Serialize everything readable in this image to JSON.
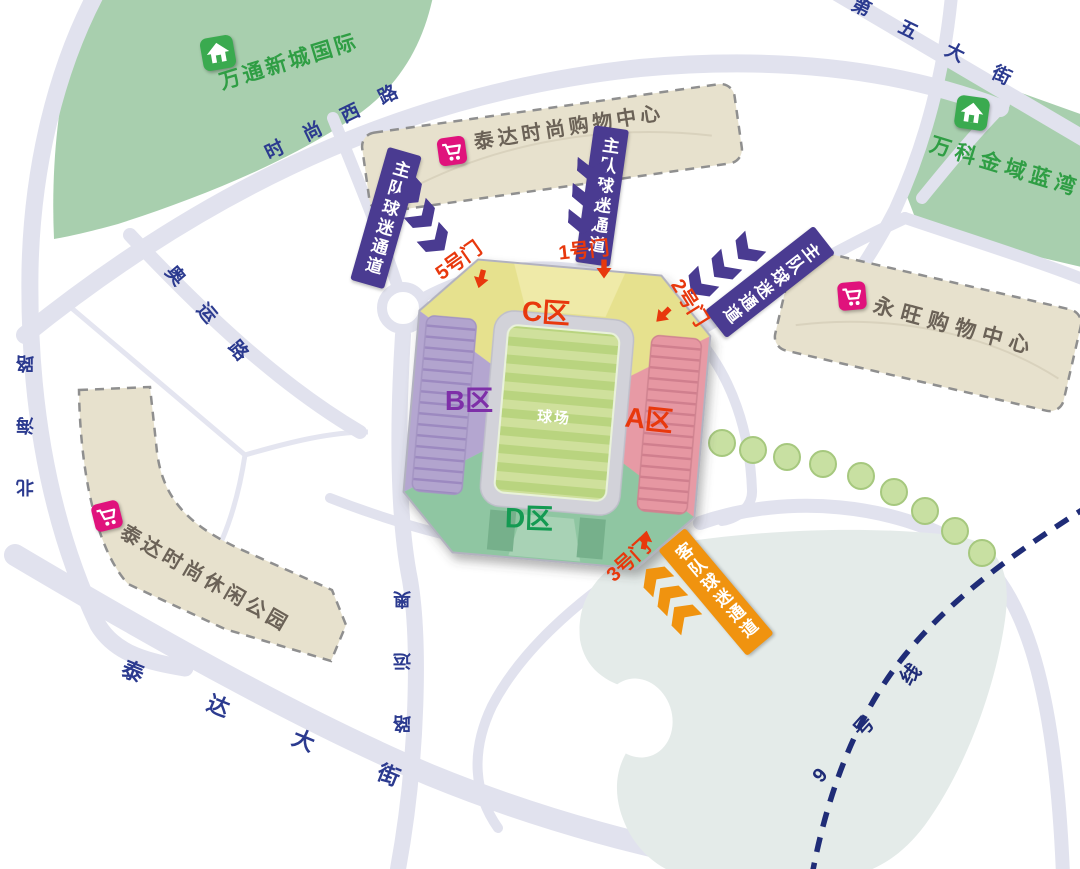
{
  "stadium": {
    "pitch_label": "球场",
    "zones": [
      {
        "id": "C",
        "label": "C区",
        "color": "#e6e18e",
        "label_color": "#e8380d"
      },
      {
        "id": "B",
        "label": "B区",
        "color": "#b4a6d0",
        "label_color": "#7e2fa8"
      },
      {
        "id": "A",
        "label": "A区",
        "color": "#e79aa5",
        "label_color": "#e8380d"
      },
      {
        "id": "D",
        "label": "D区",
        "color": "#8fc6a2",
        "label_color": "#149a52"
      }
    ],
    "gates": [
      {
        "id": "1",
        "label": "1号门"
      },
      {
        "id": "2",
        "label": "2号门"
      },
      {
        "id": "3",
        "label": "3号门"
      },
      {
        "id": "5",
        "label": "5号门"
      }
    ],
    "gate_color": "#e8380d"
  },
  "channels": {
    "home": {
      "label": "主队球迷通道",
      "color": "#4a3b91",
      "banner_count": 3
    },
    "away": {
      "label": "客队球迷通道",
      "color": "#f0930f",
      "banner_count": 1
    }
  },
  "landmarks": [
    {
      "name": "万通新城国际",
      "type": "residential",
      "icon": "home-icon",
      "text_color": "#2f9e44"
    },
    {
      "name": "泰达时尚购物中心",
      "type": "shopping",
      "icon": "cart-icon",
      "text_color": "#6b6257"
    },
    {
      "name": "万科金域蓝湾",
      "type": "residential",
      "icon": "home-icon",
      "text_color": "#2f9e44"
    },
    {
      "name": "永旺购物中心",
      "type": "shopping",
      "icon": "cart-icon",
      "text_color": "#6b6257"
    },
    {
      "name": "泰达时尚休闲公园",
      "type": "shopping",
      "icon": "cart-icon",
      "text_color": "#6b6257"
    }
  ],
  "roads": [
    {
      "name": "时尚西路"
    },
    {
      "name": "第五大街"
    },
    {
      "name": "奥运路"
    },
    {
      "name": "北海路"
    },
    {
      "name": "奥运路"
    },
    {
      "name": "泰达大街"
    }
  ],
  "metro": {
    "label": "9号线",
    "color": "#1f2c77"
  },
  "colors": {
    "road_fill": "#e1e2ee",
    "green_area": "#a8cfae",
    "building_fill": "#e7e1cd",
    "pond": "#e4ebe9",
    "road_text": "#2b3a8f",
    "gate_text": "#e8380d"
  }
}
